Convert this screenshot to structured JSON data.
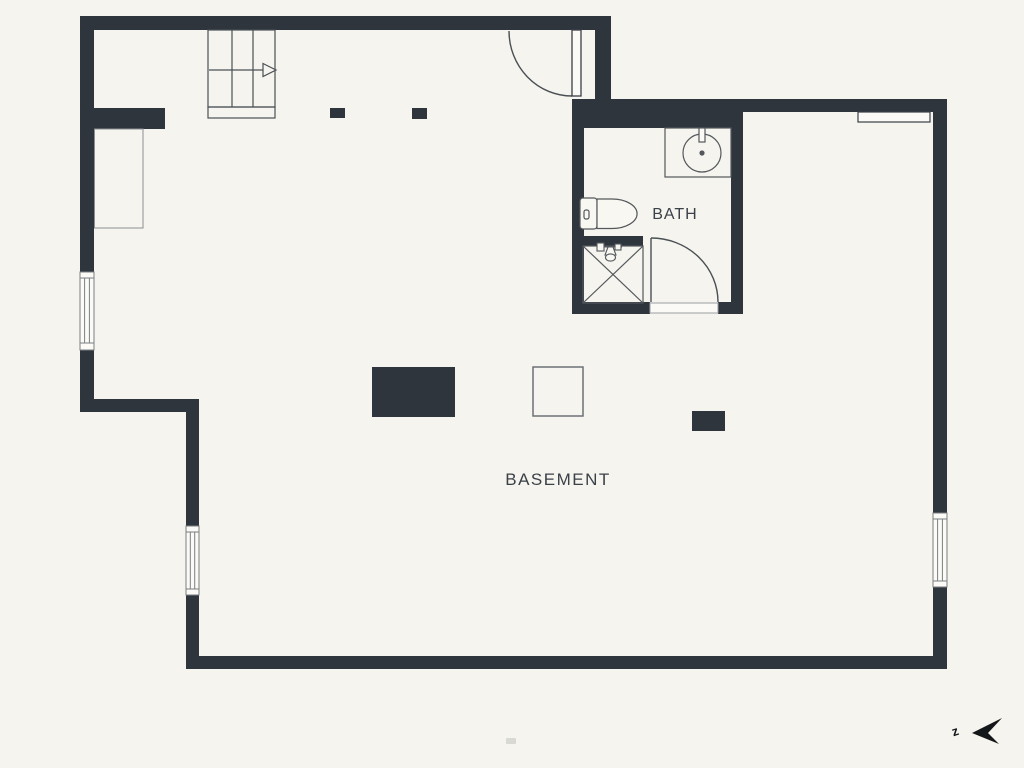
{
  "title": "Basement floor plan",
  "labels": {
    "room_main": "BASEMENT",
    "room_bath": "BATH",
    "compass_letter": "z"
  },
  "colors": {
    "wall": "#2e353d",
    "background": "#f5f4ee",
    "floor": "#f6f5f0",
    "line": "#4a5055",
    "line_light": "#8a8e92",
    "text": "#3b4148",
    "compass": "#14171a"
  },
  "icons": {
    "stairs": "stairs-up-arrow-icon",
    "entry_door": "door-swing-icon",
    "bath_door": "door-swing-icon",
    "toilet": "toilet-icon",
    "sink": "round-basin-sink-icon",
    "shower": "shower-stall-cross-icon",
    "windows": "double-line-window-icon",
    "compass": "north-arrow-icon"
  }
}
